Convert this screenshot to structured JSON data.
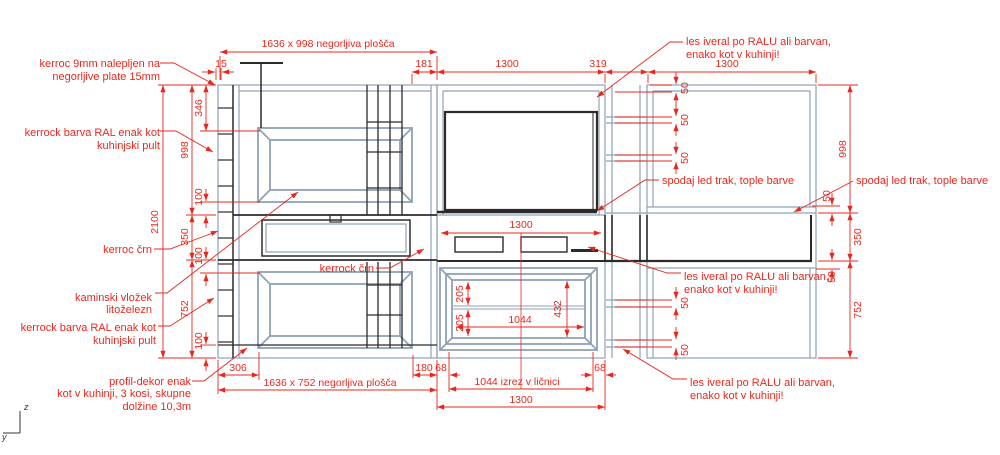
{
  "drawing": {
    "type": "furniture-elevation-cad-drawing",
    "units": "mm"
  },
  "colors": {
    "dimension_red": "#e8281e",
    "structure_black": "#2b2b2b",
    "structure_steel": "#8fa2b6",
    "background": "#ffffff"
  },
  "dims": {
    "plate_top": "1636 x 998 negorljiva plošča",
    "plate_bottom": "1636 x 752 negorljiva plošča",
    "izrez": "1044 izrez v ličnici",
    "d15": "15",
    "d181": "181",
    "d1300": "1300",
    "d319": "319",
    "d2100": "2100",
    "d998": "998",
    "d350": "350",
    "d752": "752",
    "d346": "346",
    "d100": "100",
    "d50": "50",
    "d306": "306",
    "d180": "180",
    "d68": "68",
    "d205": "205",
    "d432": "432",
    "d1044": "1044"
  },
  "callouts": {
    "kerroc9": {
      "lines": [
        "kerroc 9mm nalepljen na",
        "negorljive plate 15mm"
      ]
    },
    "kerrockRalTop": {
      "lines": [
        "kerrock barva RAL enak kot",
        "kuhinjski pult"
      ]
    },
    "kerrocCrn": {
      "lines": [
        "kerroc črn"
      ]
    },
    "kaminski": {
      "lines": [
        "kaminski vložek",
        "litoželezn"
      ]
    },
    "kerrockRalBot": {
      "lines": [
        "kerrock barva RAL enak kot",
        "kuhinjski pult"
      ]
    },
    "profilDekor": {
      "lines": [
        "profil-dekor enak",
        "kot v kuhinji, 3 kosi, skupne",
        "dolžine 10,3m"
      ]
    },
    "kerrockCrnMid": {
      "lines": [
        "kerrock črn"
      ]
    },
    "lesIveralTop": {
      "lines": [
        "les iveral po RALU ali barvan,",
        "enako kot v kuhinji!"
      ]
    },
    "spodajLedLeft": {
      "lines": [
        "spodaj led trak, tople barve"
      ]
    },
    "spodajLedRight": {
      "lines": [
        "spodaj led trak, tople barve"
      ]
    },
    "lesIveralMid": {
      "lines": [
        "les iveral po RALU ali barvan,",
        "enako kot v kuhinji!"
      ]
    },
    "lesIveralBot": {
      "lines": [
        "les iveral po RALU ali barvan,",
        "enako kot v kuhinji!"
      ]
    }
  },
  "axis": {
    "z": "z",
    "y": "y"
  }
}
